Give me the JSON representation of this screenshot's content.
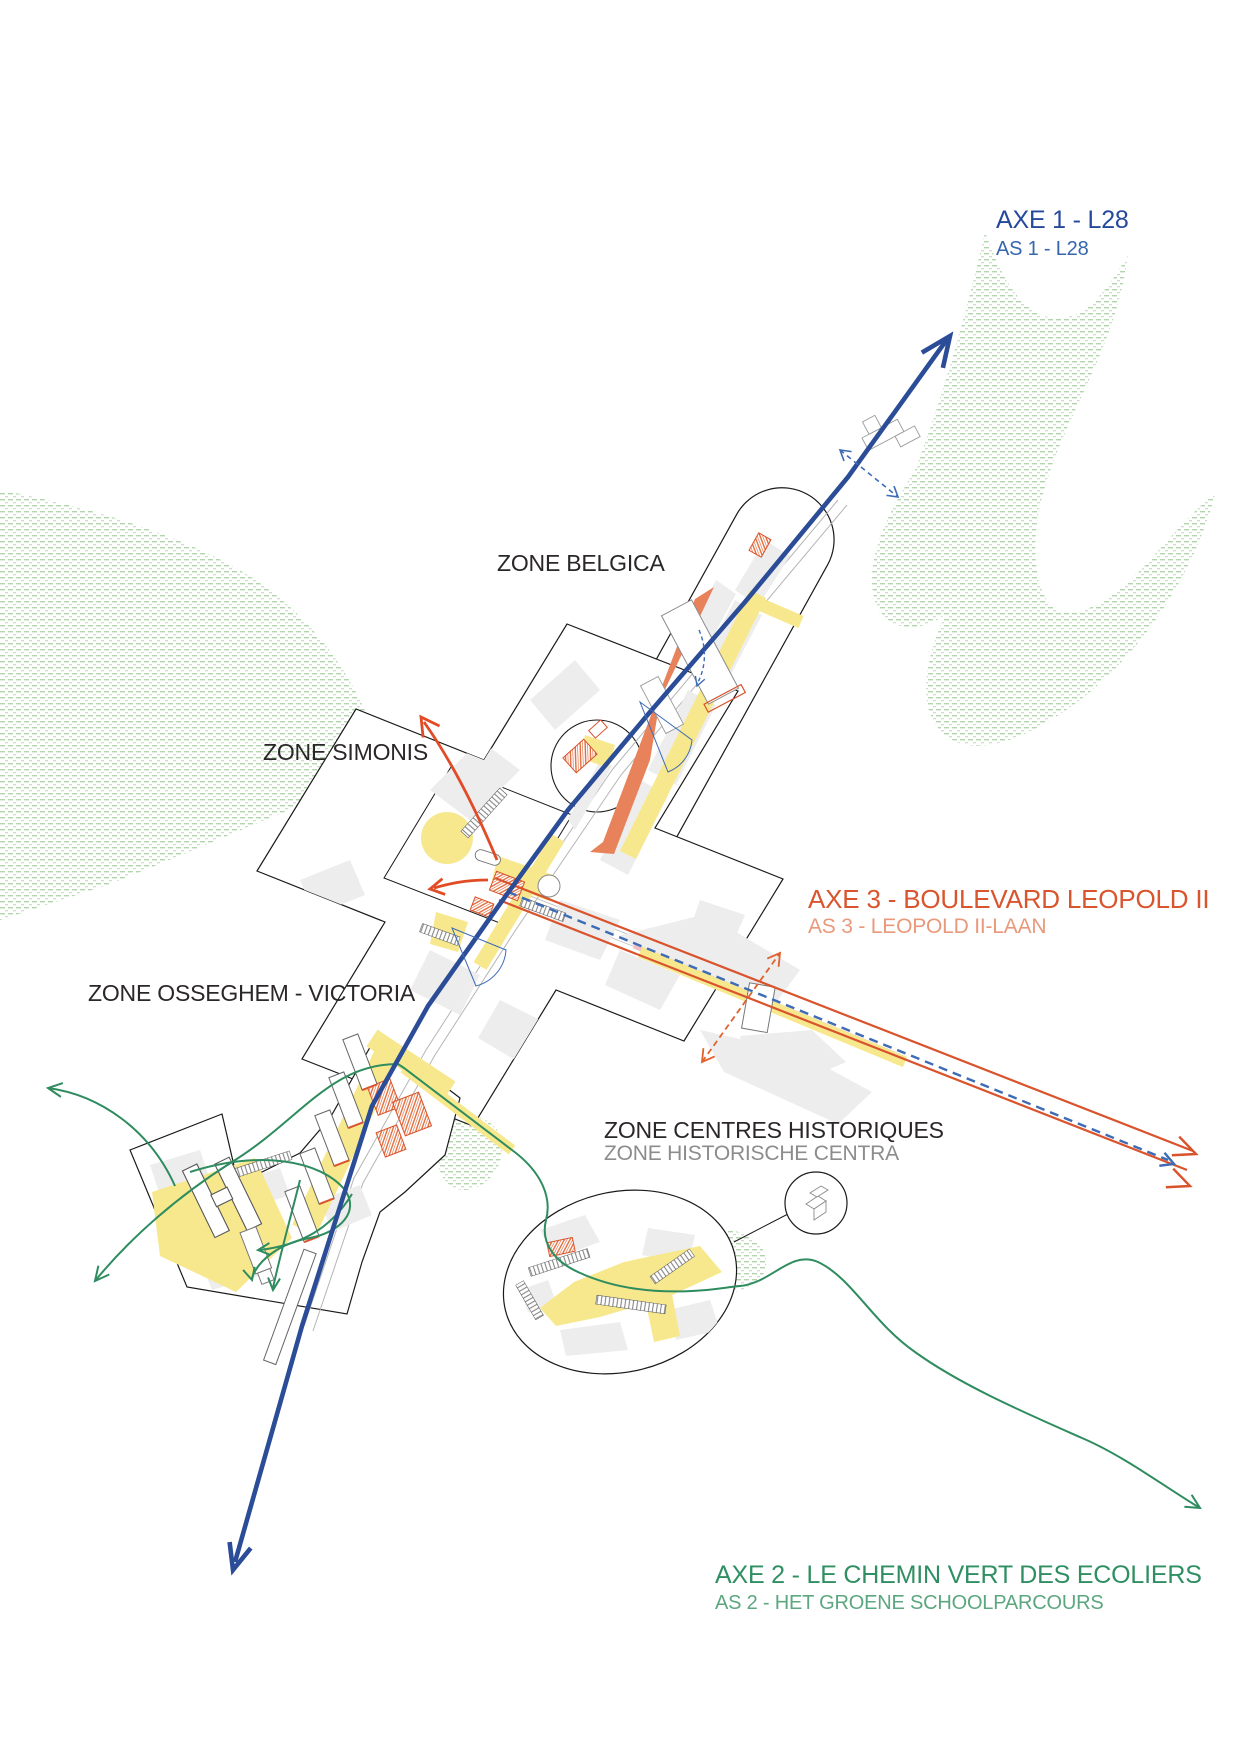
{
  "page": {
    "background": "#FFFFFF",
    "type": "urban-masterplan-diagram"
  },
  "axes": {
    "axe1": {
      "label_fr": "AXE 1 - L28",
      "label_nl": "AS 1 - L28",
      "color_fr": "#27499B",
      "color_nl": "#3566AE",
      "line_color": "#2B4C97"
    },
    "axe2": {
      "label_fr": "AXE 2 - LE CHEMIN VERT DES ECOLIERS",
      "label_nl": "AS 2 - HET GROENE SCHOOLPARCOURS",
      "color_fr": "#2F8F62",
      "color_nl": "#5CA77F",
      "line_color": "#2E8C5F"
    },
    "axe3": {
      "label_fr": "AXE 3 - BOULEVARD LEOPOLD II",
      "label_nl": "AS 3 - LEOPOLD II-LAAN",
      "color_fr": "#D9552E",
      "color_nl": "#E9997B",
      "line_color": "#D9532C"
    }
  },
  "zones": {
    "belgica": {
      "label": "ZONE BELGICA"
    },
    "simonis": {
      "label": "ZONE SIMONIS"
    },
    "osseghem_victoria": {
      "label": "ZONE OSSEGHEM - VICTORIA"
    },
    "centres_historiques": {
      "label_fr": "ZONE CENTRES HISTORIQUES",
      "label_nl": "ZONE HISTORISCHE CENTRA"
    }
  },
  "palette": {
    "map_yellow": "#F7E88D",
    "map_pink": "#F1BFC1",
    "map_orange_fill": "#E8825A",
    "green_hatch": "#ABD0A6",
    "building_gray": "#EDEDED",
    "zone_outline": "#1A1A1A",
    "red_arrow": "#E14B26",
    "blue_dashed": "#3E6BB5",
    "rail_gray": "#B5B5B5"
  }
}
